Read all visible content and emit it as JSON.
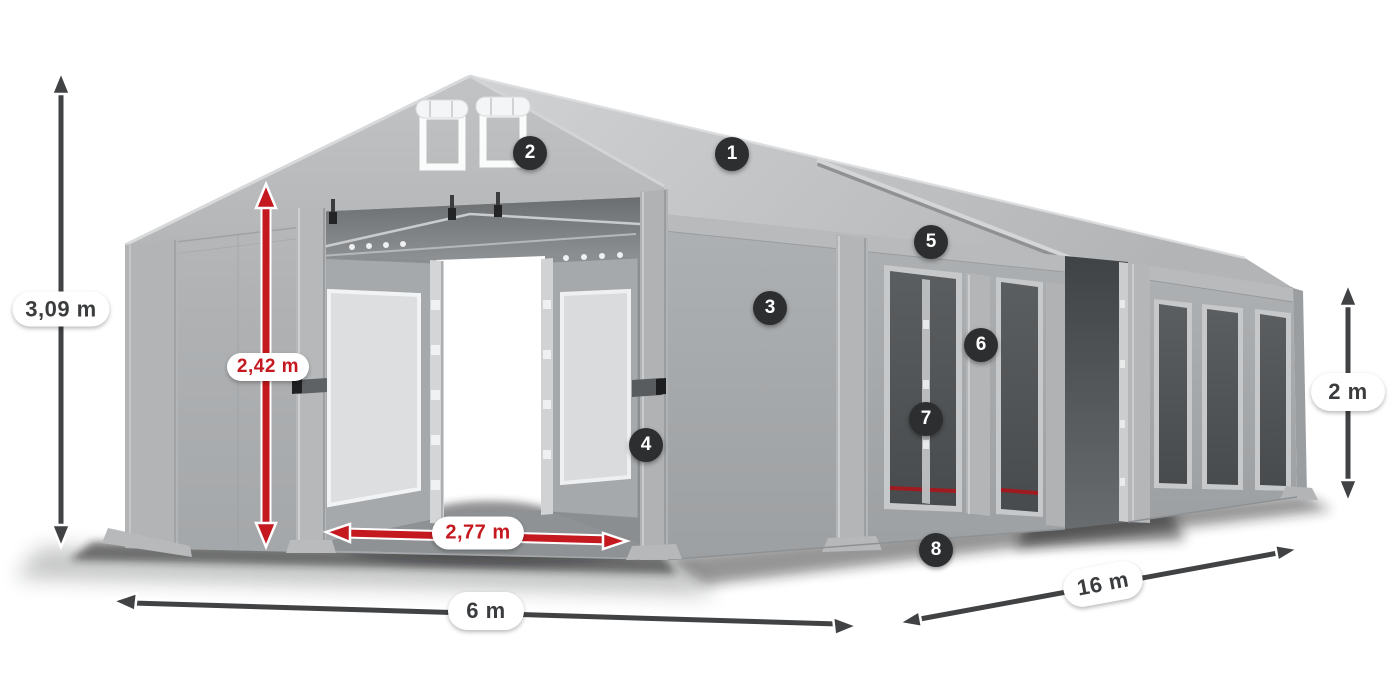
{
  "figure": {
    "description_visible": false
  },
  "dimensions": {
    "total_height": "3,09 m",
    "entrance_height": "2,42 m",
    "entrance_width": "2,77 m",
    "width": "6 m",
    "length": "16 m",
    "side_height": "2 m"
  },
  "callouts": [
    {
      "number": "1"
    },
    {
      "number": "2"
    },
    {
      "number": "3"
    },
    {
      "number": "4"
    },
    {
      "number": "5"
    },
    {
      "number": "6"
    },
    {
      "number": "7"
    },
    {
      "number": "8"
    }
  ],
  "colors": {
    "accent_red": "#c4191f",
    "arrow_dark": "#404244",
    "badge_background": "#2d2e30",
    "badge_text": "#ffffff",
    "label_background": "#ffffff",
    "label_text": "#3a3c3e",
    "tent_fabric_light": "#c7c9cb",
    "tent_fabric_mid": "#a8abad",
    "tent_interior_dark": "#6e7173",
    "window_mesh": "#4d5052",
    "frame_silver": "#d2d4d5"
  }
}
